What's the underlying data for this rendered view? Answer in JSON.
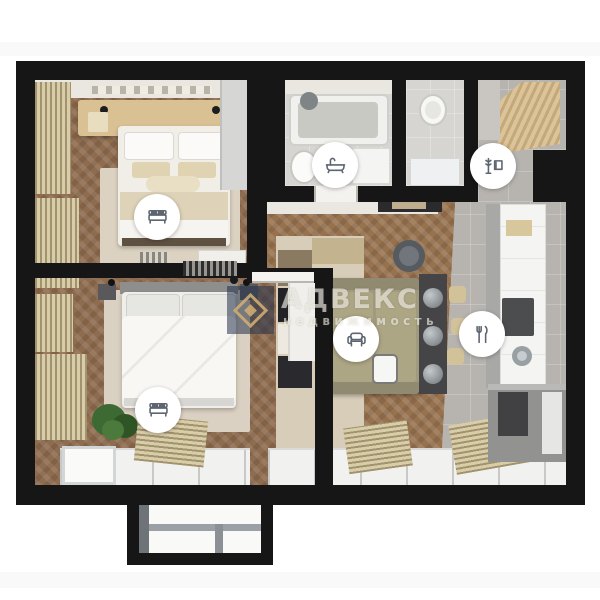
{
  "watermark": {
    "brand": "АДВЕКС",
    "subtitle": "недвижимость",
    "monogram": "А",
    "brand_text_color": "rgba(250,247,240,0.62)",
    "logo_background": "#24324a",
    "logo_gold": "#ceac70"
  },
  "floorplan": {
    "type": "apartment-3d-top-view-render",
    "wall_color": "#161616",
    "colors": {
      "bedroom_wood_floor": "#8e6c4f",
      "living_wood_floor": "#97724f",
      "kitchen_tile_floor": "#b7b4b0",
      "bathroom_floor": "#d7d5d1",
      "rug": "#dbd1c2",
      "sofa": "#a09a7e",
      "curtain": "#d8cda9",
      "headboard_wood": "#d9c194"
    },
    "icons": [
      {
        "name": "bed-icon",
        "room": "bedroom-top-left"
      },
      {
        "name": "bed-icon",
        "room": "bedroom-bottom-left"
      },
      {
        "name": "bathtub-icon",
        "room": "bathroom"
      },
      {
        "name": "coat-rack-icon",
        "room": "entry-hall"
      },
      {
        "name": "armchair-icon",
        "room": "living-room"
      },
      {
        "name": "cutlery-icon",
        "room": "kitchen"
      }
    ]
  }
}
